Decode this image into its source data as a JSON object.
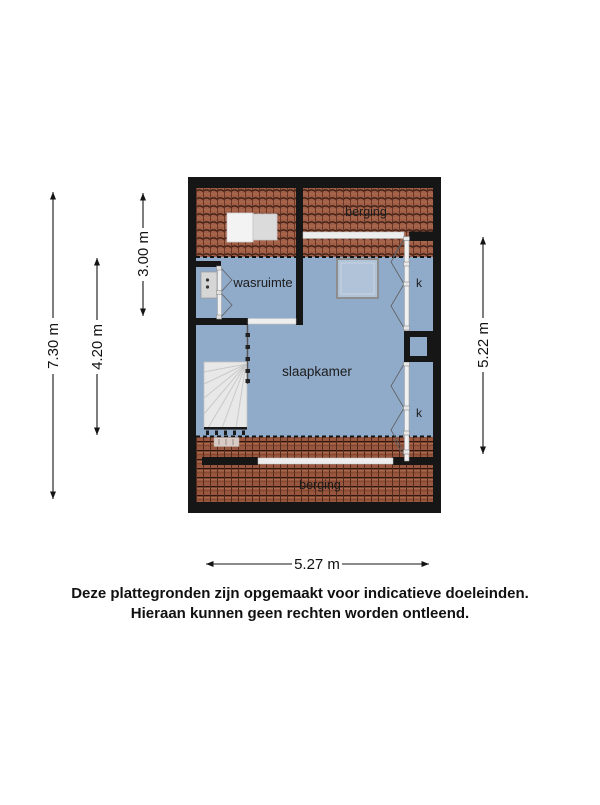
{
  "plan": {
    "rooms": {
      "berging_top": "berging",
      "wasruimte": "wasruimte",
      "slaapkamer": "slaapkamer",
      "kast_top": "k",
      "kast_bottom": "k",
      "berging_bottom": "berging"
    },
    "dimensions": {
      "height_total": "7.30 m",
      "height_floor": "4.20 m",
      "height_top_section": "3.00 m",
      "height_right": "5.22 m",
      "width_bottom": "5.27 m"
    },
    "colors": {
      "floor": "#90aac9",
      "roof_tile": "#9c5a43",
      "wall": "#161616",
      "white_elements": "#ededed"
    }
  },
  "disclaimer": {
    "line1": "Deze plattegronden zijn opgemaakt voor indicatieve doeleinden.",
    "line2": "Hieraan kunnen geen rechten worden ontleend."
  }
}
